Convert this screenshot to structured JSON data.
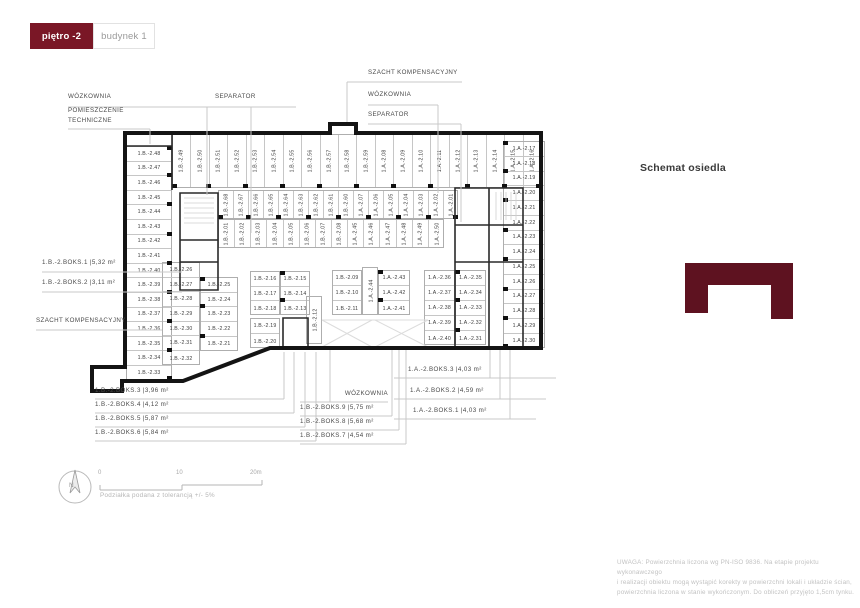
{
  "toolbar": {
    "floor_label": "piętro -2",
    "building_label": "budynek 1"
  },
  "schemat": {
    "title": "Schemat osiedla"
  },
  "plan": {
    "groups": {
      "left_col": [
        "1.B.-2.48",
        "1.B.-2.47",
        "1.B.-2.46",
        "1.B.-2.45",
        "1.B.-2.44",
        "1.B.-2.43",
        "1.B.-2.42",
        "1.B.-2.41",
        "1.B.-2.40",
        "1.B.-2.39",
        "1.B.-2.38",
        "1.B.-2.37",
        "1.B.-2.36",
        "1.B.-2.35",
        "1.B.-2.34",
        "1.B.-2.33"
      ],
      "top_row": [
        "1.B.-2.49",
        "1.B.-2.50",
        "1.B.-2.51",
        "1.B.-2.52",
        "1.B.-2.53",
        "1.B.-2.54",
        "1.B.-2.55",
        "1.B.-2.56",
        "1.B.-2.57",
        "1.B.-2.58",
        "1.B.-2.59",
        "1.A.-2.08",
        "1.A.-2.09",
        "1.A.-2.10",
        "1.A.-2.11",
        "1.A.-2.12",
        "1.A.-2.13",
        "1.A.-2.14",
        "1.A.-2.15",
        "1.A.-2.16"
      ],
      "band_upper": [
        "1.B.-2.68",
        "1.B.-2.67",
        "1.B.-2.66",
        "1.B.-2.65",
        "1.B.-2.64",
        "1.B.-2.63",
        "1.B.-2.62",
        "1.B.-2.61",
        "1.B.-2.60",
        "1.A.-2.07",
        "1.A.-2.06",
        "1.A.-2.05",
        "1.A.-2.04",
        "1.A.-2.03",
        "1.A.-2.02",
        "1.A.-2.01"
      ],
      "band_lower": [
        "1.B.-2.01",
        "1.B.-2.02",
        "1.B.-2.03",
        "1.B.-2.04",
        "1.B.-2.05",
        "1.B.-2.06",
        "1.B.-2.07",
        "1.B.-2.08",
        "1.A.-2.45",
        "1.A.-2.46",
        "1.A.-2.47",
        "1.A.-2.48",
        "1.A.-2.49",
        "1.A.-2.50"
      ],
      "block26_c1": [
        "1.B.-2.26",
        "1.B.-2.27",
        "1.B.-2.28",
        "1.B.-2.29",
        "1.B.-2.30",
        "1.B.-2.31",
        "1.B.-2.32"
      ],
      "block26_c2": [
        "1.B.-2.25",
        "1.B.-2.24",
        "1.B.-2.23",
        "1.B.-2.22",
        "1.B.-2.21"
      ],
      "block16_c1": [
        "1.B.-2.16",
        "1.B.-2.17",
        "1.B.-2.18"
      ],
      "block16_c2": [
        "1.B.-2.15",
        "1.B.-2.14",
        "1.B.-2.13"
      ],
      "block16_c3": [
        "1.B.-2.19",
        "1.B.-2.20"
      ],
      "block09_c1": [
        "1.B.-2.09",
        "1.B.-2.10",
        "1.B.-2.11"
      ],
      "stall12": [
        "1.B.-2.12"
      ],
      "stall44": [
        "1.A.-2.44"
      ],
      "block09_c2": [
        "1.A.-2.43",
        "1.A.-2.42",
        "1.A.-2.41"
      ],
      "block36_c1": [
        "1.A.-2.36",
        "1.A.-2.37",
        "1.A.-2.38",
        "1.A.-2.39",
        "1.A.-2.40"
      ],
      "block36_c2": [
        "1.A.-2.35",
        "1.A.-2.34",
        "1.A.-2.33",
        "1.A.-2.32",
        "1.A.-2.31"
      ],
      "right_col": [
        "1.A.-2.17",
        "1.A.-2.18",
        "1.A.-2.19",
        "1.A.-2.20",
        "1.A.-2.21",
        "1.A.-2.22",
        "1.A.-2.23",
        "1.A.-2.24",
        "1.A.-2.25",
        "1.A.-2.26",
        "1.A.-2.27",
        "1.A.-2.28",
        "1.A.-2.29",
        "1.A.-2.30"
      ]
    },
    "annotations": {
      "wozkownia_tl": "WÓZKOWNIA",
      "pom_tech": [
        "POMIESZCZENIE",
        "TECHNICZNE"
      ],
      "separator_tc": "SEPARATOR",
      "szacht_tr": "SZACHT KOMPENSACYJNY",
      "wozkownia_r": "WÓZKOWNIA",
      "separator_r": "SEPARATOR",
      "boks_b1": "1.B.-2.BOKS.1 |5,32 m²",
      "boks_b2": "1.B.-2.BOKS.2 |3,11 m²",
      "szacht_l": "SZACHT KOMPENSACYJNY",
      "boks_b3": "1.B.-2.BOKS.3 |3,96 m²",
      "boks_b4": "1.B.-2.BOKS.4 |4,12 m²",
      "boks_b5": "1.B.-2.BOKS.5 |5,87 m²",
      "boks_b6": "1.B.-2.BOKS.6 |5,84 m²",
      "wozkownia_b": "WÓZKOWNIA",
      "boks_b9": "1.B.-2.BOKS.9 |5,75 m²",
      "boks_b8": "1.B.-2.BOKS.8 |5,68 m²",
      "boks_b7": "1.B.-2.BOKS.7 |4,54 m²",
      "boks_a3": "1.A.-2.BOKS.3 |4,03 m²",
      "boks_a2": "1.A.-2.BOKS.2 |4,59 m²",
      "boks_a1": "1.A.-2.BOKS.1 |4,03 m²"
    }
  },
  "scalebar": {
    "tick0": "0",
    "tick10": "10",
    "tick20": "20m",
    "caption": "Podziałka podana z tolerancją +/- 5%",
    "north": "N"
  },
  "disclaimer": {
    "line1": "UWAGA: Powierzchnia liczona wg PN-ISO 9836. Na etapie projektu wykonawczego",
    "line2": "i realizacji obiektu mogą wystąpić korekty w powierzchni lokali i układzie ścian,",
    "line3": "powierzchnia liczona w stanie wykończonym. Do obliczeń przyjęto 1,5cm tynku."
  },
  "colors": {
    "accent": "#7a1726",
    "schemat_shape": "#5e1220"
  }
}
